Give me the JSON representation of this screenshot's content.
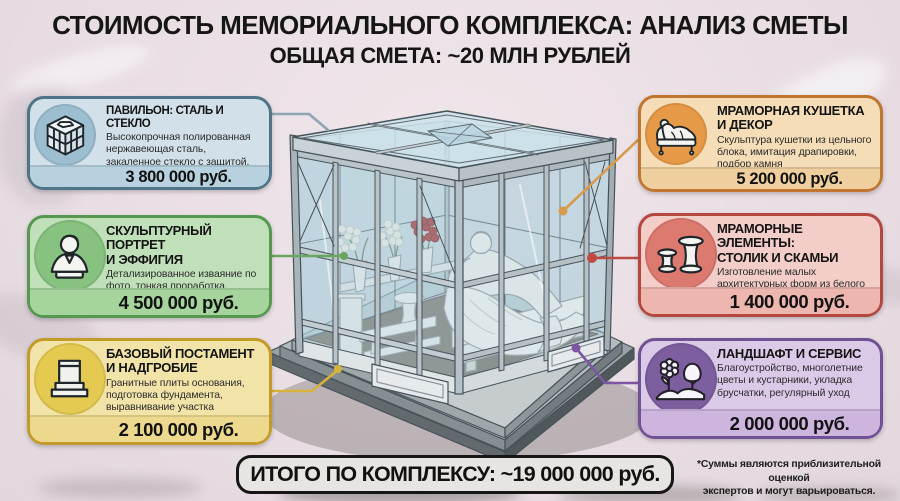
{
  "header": {
    "title": "СТОИМОСТЬ МЕМОРИАЛЬНОГО КОМПЛЕКСА: АНАЛИЗ СМЕТЫ",
    "subtitle": "ОБЩАЯ СМЕТА: ~20 МЛН РУБЛЕЙ"
  },
  "cards": [
    {
      "id": "pavilion",
      "icon": "glass-pavilion-icon",
      "title": "ПАВИЛЬОН: СТАЛЬ И СТЕКЛО",
      "desc": "Высокопрочная полированная нержавеющая сталь, закаленное стекло с защитой, профессиональный монтаж.",
      "price": "3 800 000 руб.",
      "colors": {
        "border": "#4f7488",
        "fill": "#d2e1e9",
        "circle": "#9dbed1",
        "band": "#b7d1de",
        "line": "#8fa6b3"
      }
    },
    {
      "id": "sculpture",
      "icon": "sculpture-bust-icon",
      "title": "СКУЛЬПТУРНЫЙ ПОРТРЕТ\nИ ЭФФИГИЯ",
      "desc": "Детализированное изваяние по фото, тонкая проработка, уникальный дизайн",
      "price": "4 500 000 руб.",
      "colors": {
        "border": "#569850",
        "fill": "#c0e0ba",
        "circle": "#88c281",
        "band": "#a5d49d",
        "line": "#69a75f"
      }
    },
    {
      "id": "pedestal",
      "icon": "pedestal-icon",
      "title": "БАЗОВЫЙ ПОСТАМЕНТ\nИ НАДГРОБИЕ",
      "desc": "Гранитные плиты основания, подготовка фундамента, выравнивание участка",
      "price": "2 100 000 руб.",
      "colors": {
        "border": "#c39b2b",
        "fill": "#f2e4a9",
        "circle": "#e5ca52",
        "band": "#ecd98e",
        "line": "#d8b33b"
      }
    },
    {
      "id": "couch",
      "icon": "marble-couch-icon",
      "title": "МРАМОРНАЯ КУШЕТКА\nИ ДЕКОР",
      "desc": "Скульптура кушетки из цельного блока, имитация драпировки, подбор камня",
      "price": "5 200 000 руб.",
      "colors": {
        "border": "#c07530",
        "fill": "#f5ddb7",
        "circle": "#e69a47",
        "band": "#efcf9e",
        "line": "#d79b4d"
      }
    },
    {
      "id": "marble-elements",
      "icon": "table-and-bench-icon",
      "title": "МРАМОРНЫЕ ЭЛЕМЕНТЫ:\nСТОЛИК И СКАМЬИ",
      "desc": "Изготовление малых архитектурных форм из белого мрамора (столик, 2 скамьи).",
      "price": "1 400 000 руб.",
      "colors": {
        "border": "#b4473f",
        "fill": "#f3cdc8",
        "circle": "#dd7a70",
        "band": "#edb7b0",
        "line": "#bf4a42"
      }
    },
    {
      "id": "landscape",
      "icon": "landscape-icon",
      "title": "ЛАНДШАФТ И СЕРВИС",
      "desc": "Благоустройство, многолетние цветы и кустарники, укладка брусчатки, регулярный уход",
      "price": "2 000 000 руб.",
      "colors": {
        "border": "#715195",
        "fill": "#dbc9e8",
        "circle": "#7d5fa0",
        "band": "#cdb5de",
        "line": "#7e57a4"
      }
    }
  ],
  "total": {
    "label": "ИТОГО ПО КОМПЛЕКСУ: ~19 000 000 руб."
  },
  "footnote": {
    "line1": "*Суммы являются приблизительной оценкой",
    "line2": "экспертов и могут варьироваться."
  },
  "palette": {
    "background": "#e8dee4",
    "total_box_bg": "#e7e4e2",
    "total_box_border": "#161616",
    "title_color": "#161616"
  }
}
